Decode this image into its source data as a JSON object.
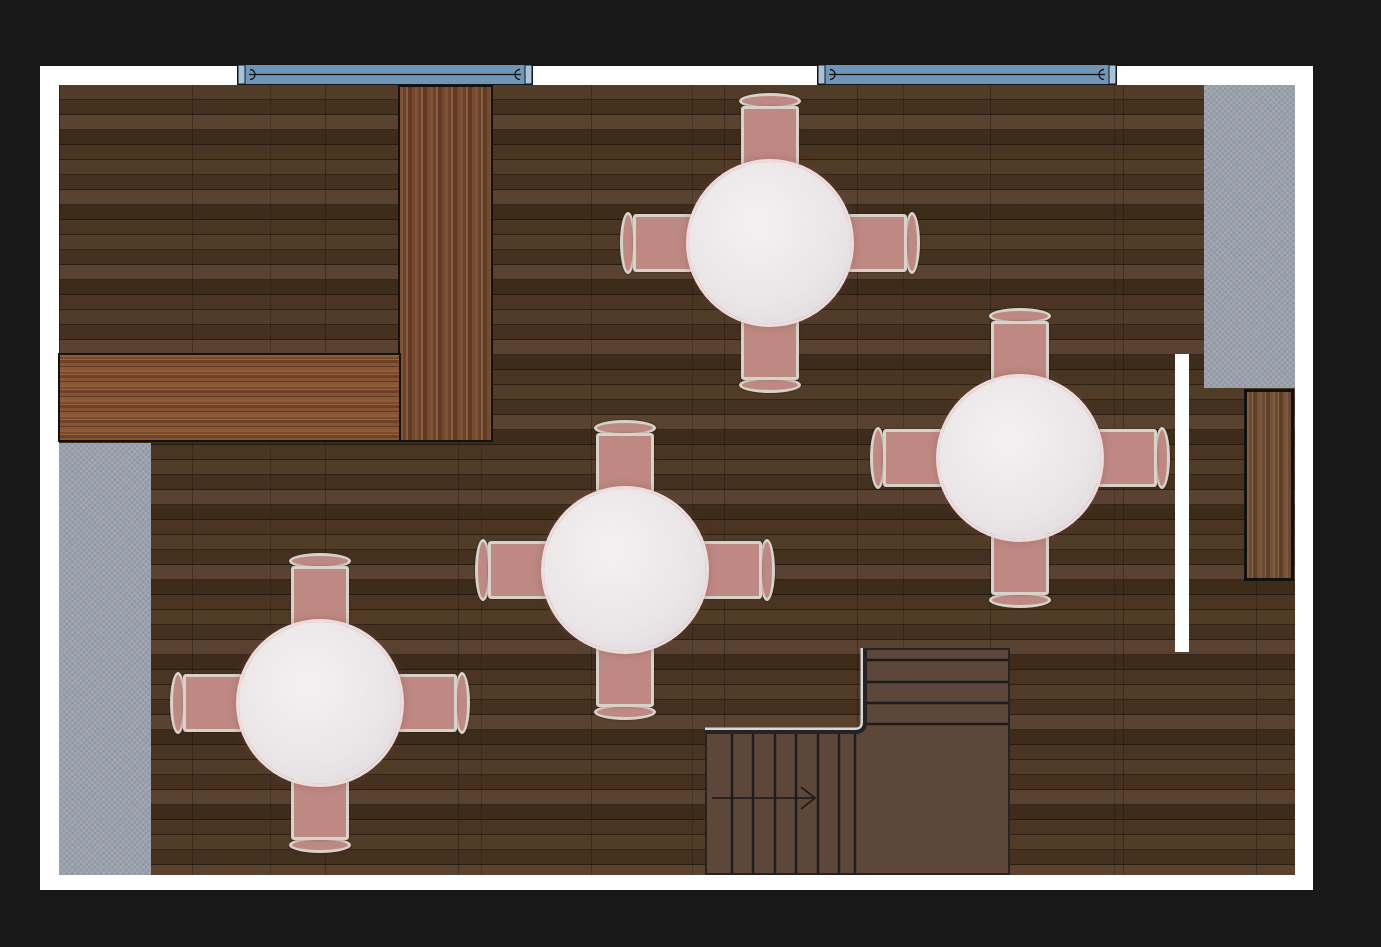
{
  "scene": {
    "type": "restaurant-dining-room-floor-plan",
    "view": "top-down",
    "floor_material": "dark-wood-parquet",
    "windows": [
      {
        "id": "window-top-left",
        "style": "double-casement"
      },
      {
        "id": "window-top-right",
        "style": "double-casement"
      }
    ],
    "bar_counter": {
      "shape": "L",
      "position": "top-left",
      "material": "polished-wood"
    },
    "tables": [
      {
        "id": "table-top",
        "shape": "round",
        "cover": "white-tablecloth",
        "chairs": 4
      },
      {
        "id": "table-right",
        "shape": "round",
        "cover": "white-tablecloth",
        "chairs": 4
      },
      {
        "id": "table-center",
        "shape": "round",
        "cover": "white-tablecloth",
        "chairs": 4
      },
      {
        "id": "table-bottom-left",
        "shape": "round",
        "cover": "white-tablecloth",
        "chairs": 4
      }
    ],
    "staircase": {
      "shape": "L",
      "position": "bottom-right",
      "direction_arrow": "right",
      "upper_flight_steps": 4,
      "lower_flight_steps": 8
    },
    "cabinet": {
      "position": "right-wall",
      "material": "wood"
    },
    "door_opening": {
      "position": "right-side",
      "appearance": "white-gap"
    },
    "gray_strips": [
      {
        "id": "strip-left",
        "position": "left-edge"
      },
      {
        "id": "strip-right",
        "position": "right-edge"
      }
    ]
  },
  "colors": {
    "background": "#181818",
    "page": "#ffffff",
    "floor_base": "#46321f",
    "window_blue": "#6f95b7",
    "window_cap": "#a6c3da",
    "window_trim": "#161616",
    "counter_wood": "#7f5133",
    "rug_gray": "#9aa1ac",
    "chair_seat": "#bf8983",
    "chair_frame": "#d7d3ca",
    "tablecloth": "#eae6e7",
    "tablecloth_trim": "#eedcdc",
    "stair_fill": "#5d463a",
    "stair_line": "#1c1c1c",
    "stair_halo": "#d8d8d8",
    "cabinet_wood": "#72553b"
  }
}
